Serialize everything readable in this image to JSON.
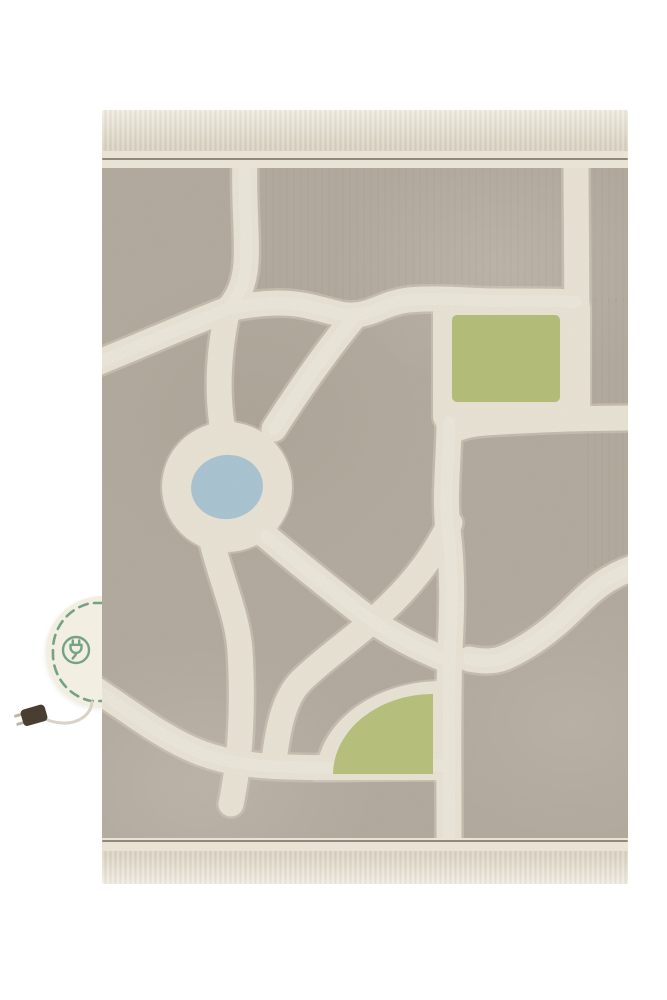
{
  "scene": {
    "description": "Product photo of a machine-washable children's play rug with a city road-map pattern, photographed flat on a white background",
    "background_color": "#ffffff"
  },
  "rug": {
    "kind": "city-roads-play-rug",
    "motifs": [
      "roads",
      "roundabout",
      "pond",
      "park-square",
      "park-quarter-circle",
      "fringed-ends"
    ],
    "palette": {
      "pile": "#b2a99d",
      "road": "#ece7d9",
      "road_shadow": "#d7d0bf",
      "road_highlight": "#f3efe3",
      "pond_blue": "#a7c5d6",
      "park_green": "#b3bf74",
      "park_green_2": "#b6c277",
      "fringe": "#e9e4d6",
      "band": "#e8e3d4",
      "edge_line": "#7c7162"
    }
  },
  "tag": {
    "kind": "round-stitched-energy-tag",
    "icon": "plug-icon",
    "accent_color": "#74a287",
    "background": "#f2eee1"
  },
  "cord": {
    "kind": "cable-with-plug",
    "cable_color": "#dad3c3",
    "plug_color": "#4a3d31",
    "prong_color": "#bdb5a6"
  }
}
